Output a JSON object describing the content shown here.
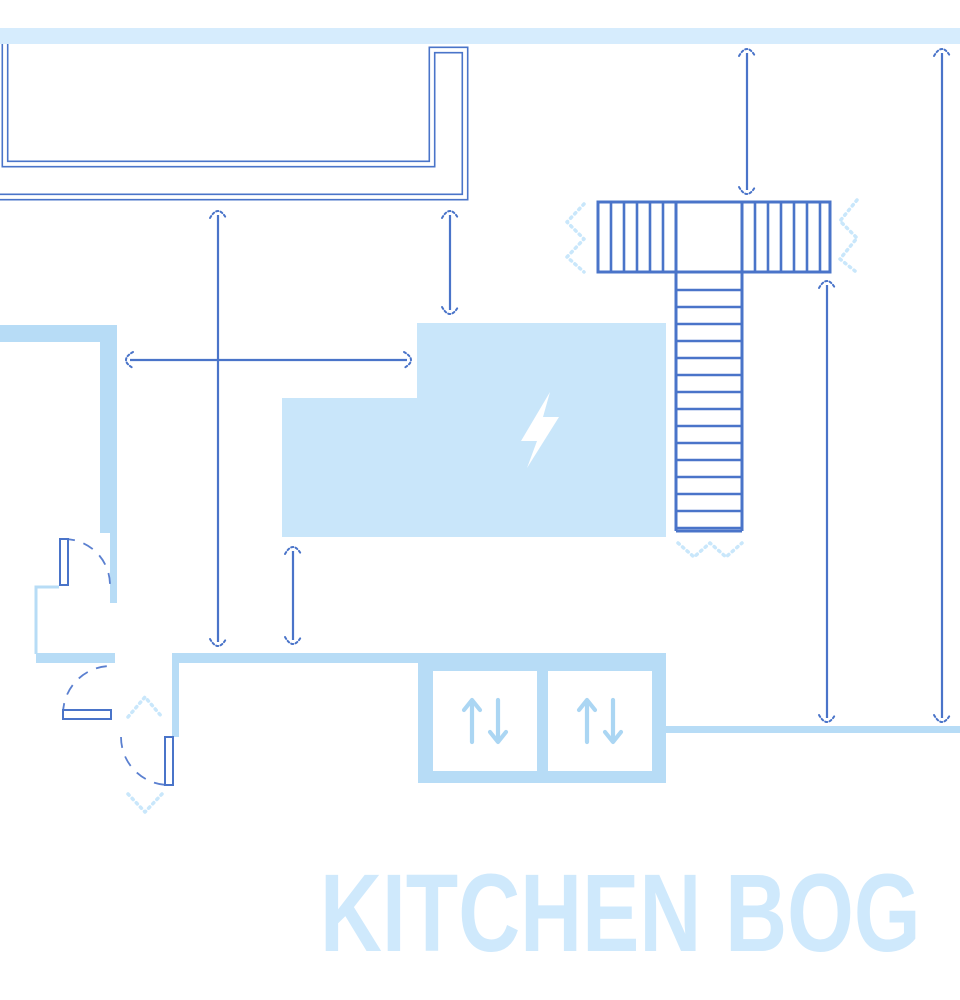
{
  "page": {
    "floor_label": "KITCHEN BOG"
  },
  "colors": {
    "line": "#4a74c9",
    "wall": "#b7dcf6",
    "room_fill": "#c9e6fa",
    "top_band": "#d6ecfd",
    "marks": "#c9e7fb",
    "text": "#cfe9fc",
    "door_arc": "#5b80d0",
    "elevator_arrow": "#abd6f3",
    "bolt": "#ffffff",
    "background": "#ffffff"
  },
  "plan": {
    "room_symbol": "lightning-bolt-icon",
    "elevators": {
      "count": 2,
      "cab_symbol": "up-down-arrows-icon"
    },
    "stairs": {
      "left_flight_treads": 5,
      "right_flight_treads": 6,
      "run_treads": 15
    },
    "dimension_lines": [
      {
        "id": "dim-left-tall",
        "orientation": "vertical",
        "x": 218,
        "from": 207,
        "to": 650
      },
      {
        "id": "dim-left-short",
        "orientation": "vertical",
        "x": 450,
        "from": 207,
        "to": 318
      },
      {
        "id": "dim-stairs-top",
        "orientation": "vertical",
        "x": 747,
        "from": 45,
        "to": 198
      },
      {
        "id": "dim-right-outer",
        "orientation": "vertical",
        "x": 942,
        "from": 45,
        "to": 726
      },
      {
        "id": "dim-right-inner",
        "orientation": "vertical",
        "x": 827,
        "from": 277,
        "to": 726
      },
      {
        "id": "dim-room-gap",
        "orientation": "vertical",
        "x": 293,
        "from": 543,
        "to": 648
      },
      {
        "id": "dim-horizontal",
        "orientation": "horizontal",
        "y": 360,
        "from": 122,
        "to": 415
      }
    ]
  }
}
